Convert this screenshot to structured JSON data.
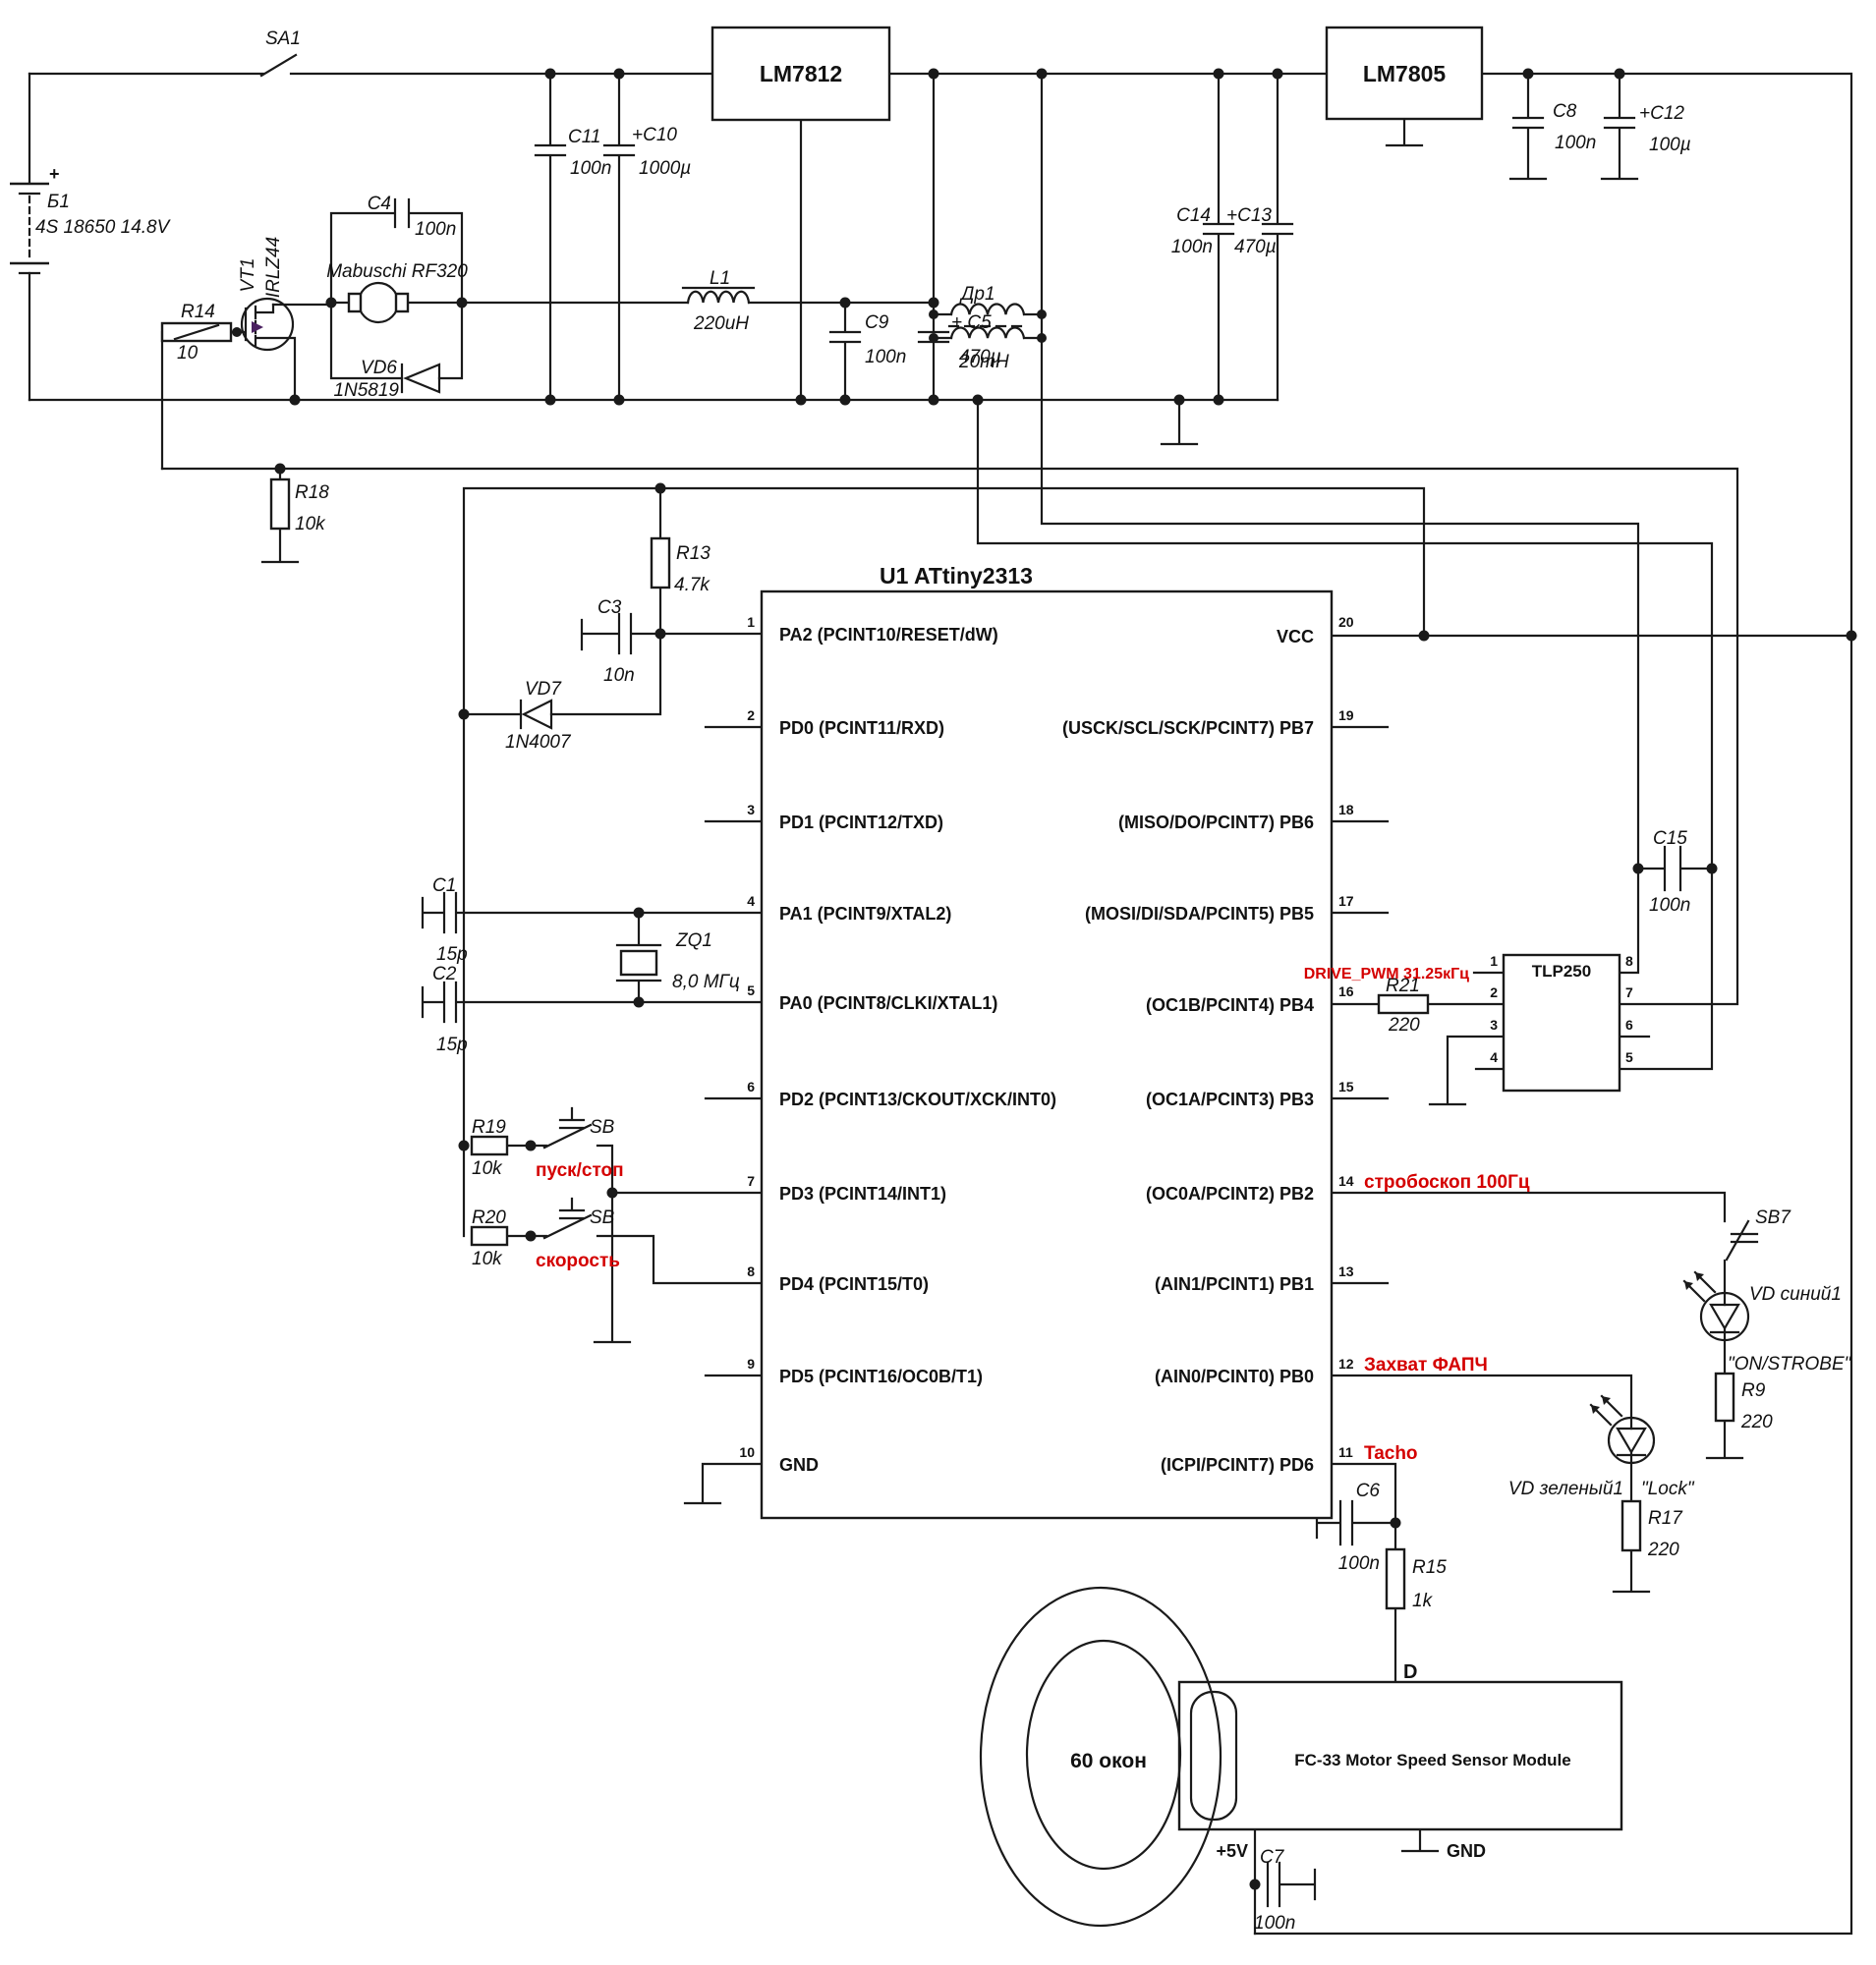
{
  "colors": {
    "wire": "#1a1a1a",
    "net_label": "#d40000"
  },
  "battery": {
    "ref": "Б1",
    "plus": "+",
    "desc": "4S 18650  14.8V"
  },
  "switches": {
    "sa1": "SA1",
    "sb_start": {
      "ref": "SB",
      "caption": "пуск/стоп"
    },
    "sb_speed": {
      "ref": "SB",
      "caption": "скорость"
    },
    "sb7": "SB7"
  },
  "regulators": {
    "u12": "LM7812",
    "u5": "LM7805"
  },
  "c": {
    "c1": {
      "r": "C1",
      "v": "15p"
    },
    "c2": {
      "r": "C2",
      "v": "15p"
    },
    "c3": {
      "r": "C3",
      "v": "10n"
    },
    "c4": {
      "r": "C4",
      "v": "100n"
    },
    "c5": {
      "r": "+ C5",
      "v": "470µ"
    },
    "c6": {
      "r": "C6",
      "v": "100n"
    },
    "c7": {
      "r": "C7",
      "v": "100n"
    },
    "c8": {
      "r": "C8",
      "v": "100n"
    },
    "c9": {
      "r": "C9",
      "v": "100n"
    },
    "c10": {
      "r": "+C10",
      "v": "1000µ"
    },
    "c11": {
      "r": "C11",
      "v": "100n"
    },
    "c12": {
      "r": "+C12",
      "v": "100µ"
    },
    "c13": {
      "r": "+C13",
      "v": "470µ"
    },
    "c14": {
      "r": "C14",
      "v": "100n"
    },
    "c15": {
      "r": "C15",
      "v": "100n"
    }
  },
  "r": {
    "r9": {
      "r": "R9",
      "v": "220"
    },
    "r13": {
      "r": "R13",
      "v": "4.7k"
    },
    "r14": {
      "r": "R14",
      "v": "10"
    },
    "r15": {
      "r": "R15",
      "v": "1k"
    },
    "r17": {
      "r": "R17",
      "v": "220"
    },
    "r18": {
      "r": "R18",
      "v": "10k"
    },
    "r19": {
      "r": "R19",
      "v": "10k"
    },
    "r20": {
      "r": "R20",
      "v": "10k"
    },
    "r21": {
      "r": "R21",
      "v": "220"
    }
  },
  "l": {
    "l1": {
      "r": "L1",
      "v": "220uH"
    },
    "dr1": {
      "r": "Др1",
      "v": "20mH"
    }
  },
  "d": {
    "vd6": {
      "r": "VD6",
      "v": "1N5819"
    },
    "vd7": {
      "r": "VD7",
      "v": "1N4007"
    }
  },
  "q": {
    "vt1": {
      "r": "VT1",
      "part": "IRLZ44"
    }
  },
  "motor": {
    "name": "Mabuschi RF320"
  },
  "xtal": {
    "r": "ZQ1",
    "v": "8,0 МГц"
  },
  "mcu": {
    "title": "U1 ATtiny2313",
    "left": [
      {
        "n": "1",
        "t": "PA2 (PCINT10/RESET/dW)"
      },
      {
        "n": "2",
        "t": "PD0 (PCINT11/RXD)"
      },
      {
        "n": "3",
        "t": "PD1 (PCINT12/TXD)"
      },
      {
        "n": "4",
        "t": "PA1 (PCINT9/XTAL2)"
      },
      {
        "n": "5",
        "t": "PA0 (PCINT8/CLKI/XTAL1)"
      },
      {
        "n": "6",
        "t": "PD2 (PCINT13/CKOUT/XCK/INT0)"
      },
      {
        "n": "7",
        "t": "PD3 (PCINT14/INT1)"
      },
      {
        "n": "8",
        "t": "PD4 (PCINT15/T0)"
      },
      {
        "n": "9",
        "t": "PD5 (PCINT16/OC0B/T1)"
      },
      {
        "n": "10",
        "t": "GND"
      }
    ],
    "right": [
      {
        "n": "20",
        "t": "VCC"
      },
      {
        "n": "19",
        "t": "(USCK/SCL/SCK/PCINT7) PB7"
      },
      {
        "n": "18",
        "t": "(MISO/DO/PCINT7) PB6"
      },
      {
        "n": "17",
        "t": "(MOSI/DI/SDA/PCINT5) PB5"
      },
      {
        "n": "16",
        "t": "(OC1B/PCINT4) PB4"
      },
      {
        "n": "15",
        "t": "(OC1A/PCINT3) PB3"
      },
      {
        "n": "14",
        "t": "(OC0A/PCINT2) PB2"
      },
      {
        "n": "13",
        "t": "(AIN1/PCINT1) PB1"
      },
      {
        "n": "12",
        "t": "(AIN0/PCINT0) PB0"
      },
      {
        "n": "11",
        "t": "(ICPI/PCINT7) PD6"
      }
    ]
  },
  "opto": {
    "title": "TLP250",
    "pins": [
      "1",
      "2",
      "3",
      "4",
      "5",
      "6",
      "7",
      "8"
    ]
  },
  "nets": {
    "drive_pwm": "DRIVE_PWM 31.25кГц",
    "strobe": "стробоскоп 100Гц",
    "lock": "Захват ФАПЧ",
    "tacho": "Tacho"
  },
  "leds": {
    "blue": {
      "name": "VD синий1",
      "caption": "\"ON/STROBE\""
    },
    "green": {
      "name": "VD зеленый1",
      "caption": "\"Lock\""
    }
  },
  "sensor": {
    "module": "FC-33 Motor Speed Sensor Module",
    "pin_d": "D",
    "pin_5v": "+5V",
    "pin_gnd": "GND",
    "encoder": "60 окон"
  }
}
